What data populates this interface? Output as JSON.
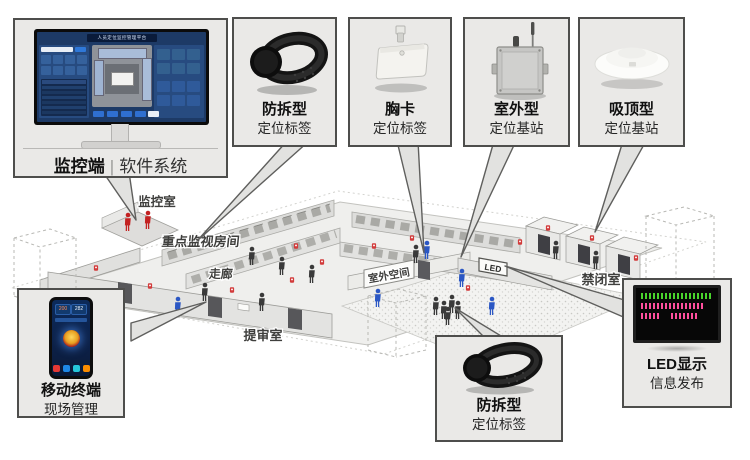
{
  "monitor_panel": {
    "label_primary": "监控端",
    "label_separator": "|",
    "label_secondary": "软件系统",
    "screen_title": "人员定位监控管理平台"
  },
  "callouts": [
    {
      "title": "防拆型",
      "subtitle": "定位标签"
    },
    {
      "title": "胸卡",
      "subtitle": "定位标签"
    },
    {
      "title": "室外型",
      "subtitle": "定位基站"
    },
    {
      "title": "吸顶型",
      "subtitle": "定位基站"
    }
  ],
  "phone_panel": {
    "title": "移动终端",
    "subtitle": "现场管理",
    "screen": {
      "stat_left": "200",
      "stat_right": "282"
    }
  },
  "bottom_tag_panel": {
    "title": "防拆型",
    "subtitle": "定位标签"
  },
  "led_panel": {
    "title": "LED显示",
    "subtitle": "信息发布"
  },
  "floorplan": {
    "rooms": {
      "monitor_room": "监控室",
      "key_watch_room": "重点监视房间",
      "corridor": "走廊",
      "outdoor_space": "室外空间",
      "led_sign": "LED",
      "confinement_room": "禁闭室",
      "interrogation_room": "提审室"
    }
  },
  "colors": {
    "box_border": "#4e4e4c",
    "box_bg": "#eae9e7",
    "dashboard_bg": "#1d3a66",
    "accent_blue": "#2f6fd0",
    "alarm_red": "#d23b3b",
    "staff_blue": "#2b57c4",
    "led_green": "#49d42c",
    "led_pink": "#ff4f9e"
  }
}
